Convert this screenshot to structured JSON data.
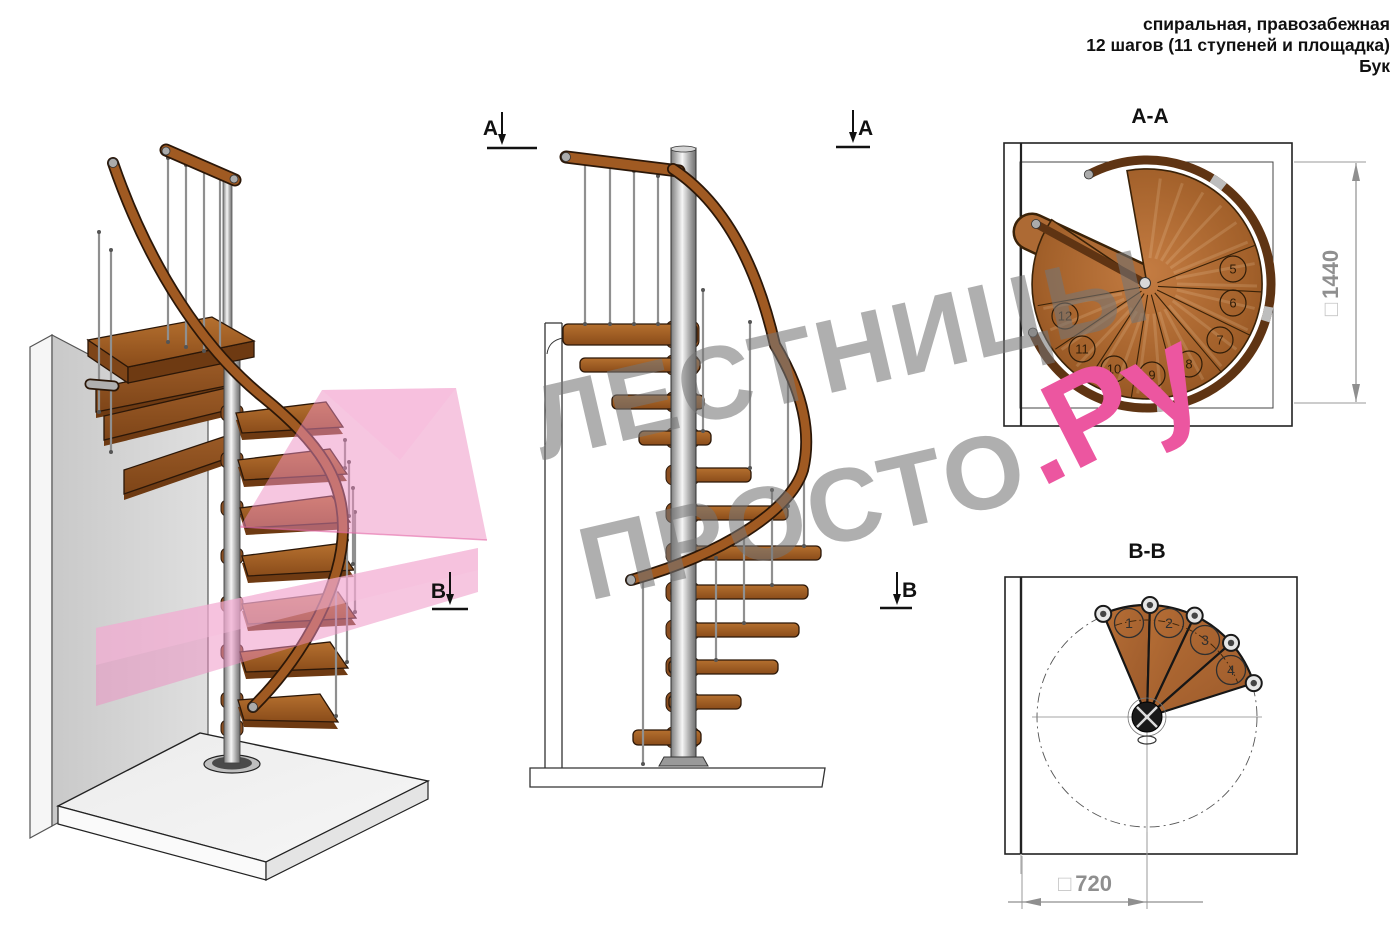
{
  "header": {
    "line1": "спиральная, правозабежная",
    "line2": "12 шагов (11 ступеней и площадка)",
    "line3": "Бук"
  },
  "watermark": {
    "top": "ЛЕСТНИЦЫ",
    "bottom": "ПРОСТО",
    "accent": ".Ру"
  },
  "sections": {
    "aa": {
      "title": "A-A",
      "marker": "A",
      "dim_symbol": "□",
      "dim_value": "1440",
      "step_numbers": [
        "5",
        "6",
        "7",
        "8",
        "9",
        "10",
        "11",
        "12"
      ]
    },
    "bb": {
      "title": "B-B",
      "marker": "B",
      "dim_symbol": "□",
      "dim_value": "720",
      "step_numbers": [
        "1",
        "2",
        "3",
        "4"
      ]
    }
  },
  "colors": {
    "accent_pink": "#ec56a0",
    "section_plane_pink": "#ee8ec2",
    "wood_brown": "#ad6a34",
    "handrail_brown": "#5f3413",
    "dimension_gray": "#8f8f8f",
    "metal_silver": "#c9c9c9"
  }
}
